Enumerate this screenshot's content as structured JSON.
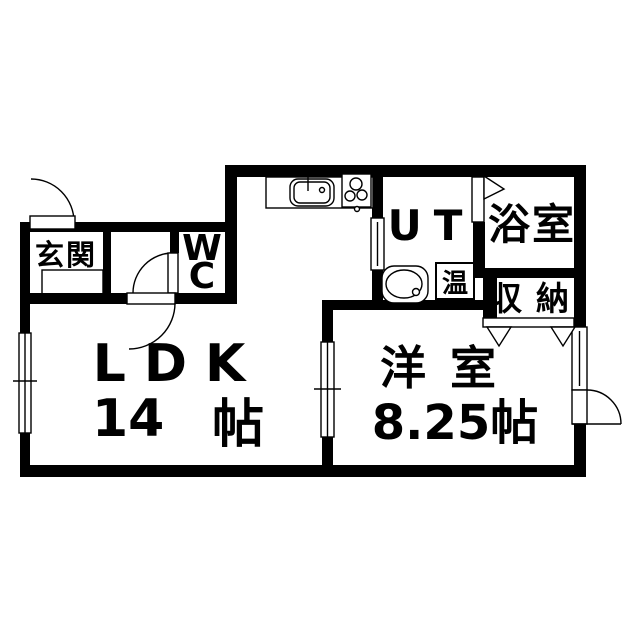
{
  "rooms": {
    "genkan": {
      "label": "玄関"
    },
    "wc": {
      "letters": [
        "W",
        "C"
      ]
    },
    "ldk": {
      "label": "LDK",
      "size_value": "14",
      "size_unit": "帖"
    },
    "ut": {
      "label": "UT"
    },
    "bath": {
      "label": "浴室"
    },
    "water_heater": {
      "label": "温"
    },
    "closet": {
      "label": "収納"
    },
    "western": {
      "label": "洋室",
      "size": "8.25帖"
    }
  },
  "colors": {
    "wall": "#000000",
    "floor": "#ffffff",
    "line": "#000000"
  }
}
